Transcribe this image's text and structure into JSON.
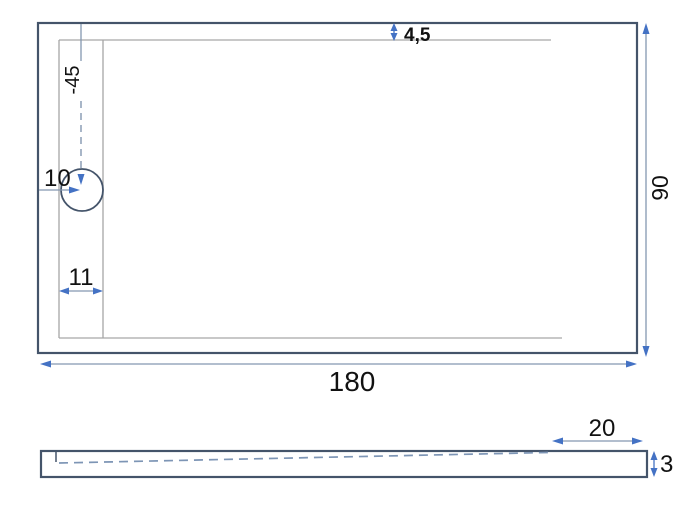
{
  "top_view": {
    "length": "180",
    "width": "90",
    "rim_width": "4,5",
    "drain_offset": "-45",
    "drain_diameter": "10",
    "drain_edge_distance": "11"
  },
  "side_view": {
    "flat_edge_length": "20",
    "edge_height": "3"
  },
  "colors": {
    "outline": "#44546A",
    "inner_line": "#A6A6A6",
    "dimension_line": "#8497B0",
    "arrow_accent": "#4472C4",
    "text": "#111111",
    "background": "#FFFFFF"
  }
}
